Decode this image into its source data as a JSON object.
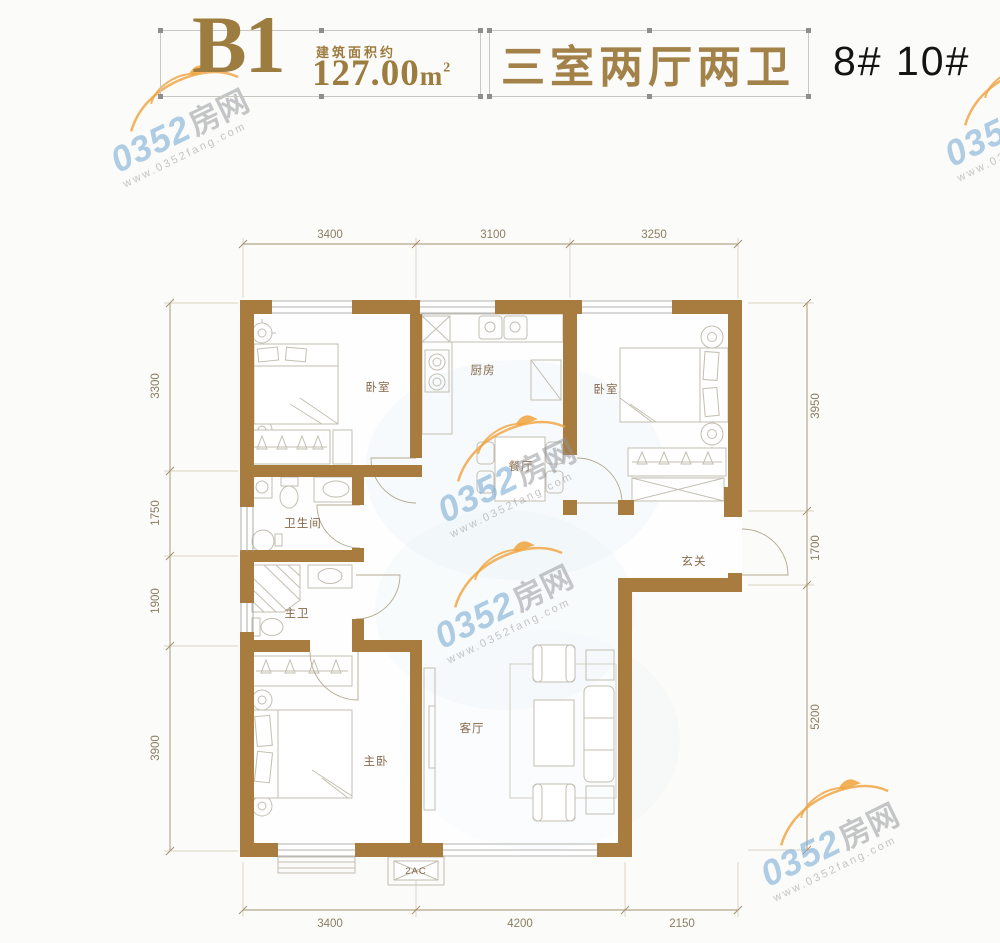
{
  "header": {
    "plan_code": "B1",
    "area_label": "建筑面积约",
    "area_value": "127.00",
    "area_unit": "m",
    "area_sup": "2",
    "layout_title": "三室两厅两卫",
    "buildings": "8# 10#"
  },
  "rooms": {
    "bedroom1": "卧室",
    "kitchen": "厨房",
    "bedroom2": "卧室",
    "dining": "餐厅",
    "bathroom": "卫生间",
    "master_bath": "主卫",
    "entry": "玄关",
    "master_bedroom": "主卧",
    "living": "客厅",
    "ac_unit": "2AC"
  },
  "dimensions": {
    "top": [
      "3400",
      "3100",
      "3250"
    ],
    "left": [
      "3300",
      "1750",
      "1900",
      "3900"
    ],
    "right": [
      "3950",
      "1700",
      "5200"
    ],
    "bottom": [
      "3400",
      "4200",
      "2150"
    ]
  },
  "watermark": {
    "brand_num": "0352",
    "brand_cn": "房网",
    "url": "www.0352fang.com"
  },
  "colors": {
    "wall_brown": "#a87c3e",
    "header_gold": "#9d7c40",
    "dim_text": "#8b7d62",
    "room_label": "#86694a",
    "furniture_line": "#c3beb2",
    "watermark_blue": "#7baed4",
    "watermark_orange": "#f0a23c"
  }
}
